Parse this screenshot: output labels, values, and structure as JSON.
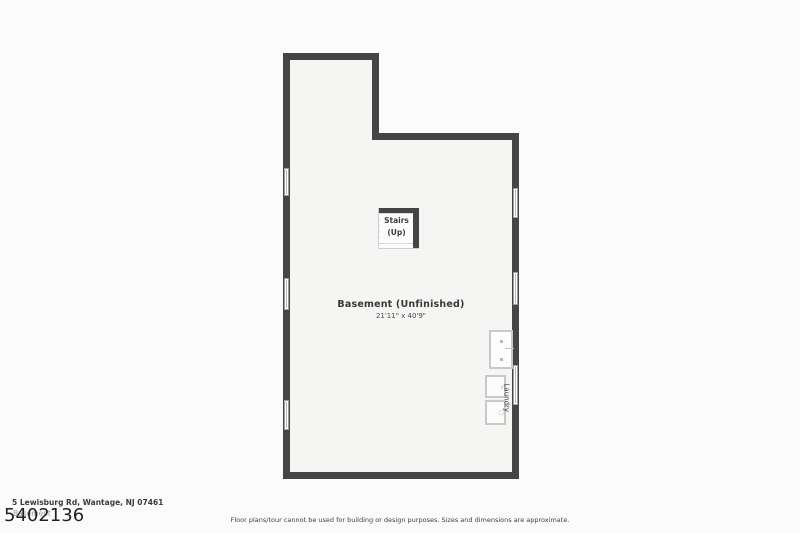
{
  "meta": {
    "background_color": "#fbfbfb",
    "wall_color": "#454545",
    "floor_color": "#f5f5f4",
    "icons": {
      "washer_icon": "≈",
      "dryer_icon": "▢"
    }
  },
  "plan": {
    "room_label": "Basement (Unfinished)",
    "room_dimensions": "21'11\" x 40'9\"",
    "stairs": {
      "line1": "Stairs",
      "line2": "(Up)"
    },
    "laundry_label": "Laundry"
  },
  "footer": {
    "address": "5 Lewisburg Rd, Wantage, NJ 07461",
    "floor_name": "Basement",
    "listing_number": "5402136",
    "disclaimer": "Floor plans/tour cannot be used for building or design purposes. Sizes and dimensions are approximate."
  }
}
